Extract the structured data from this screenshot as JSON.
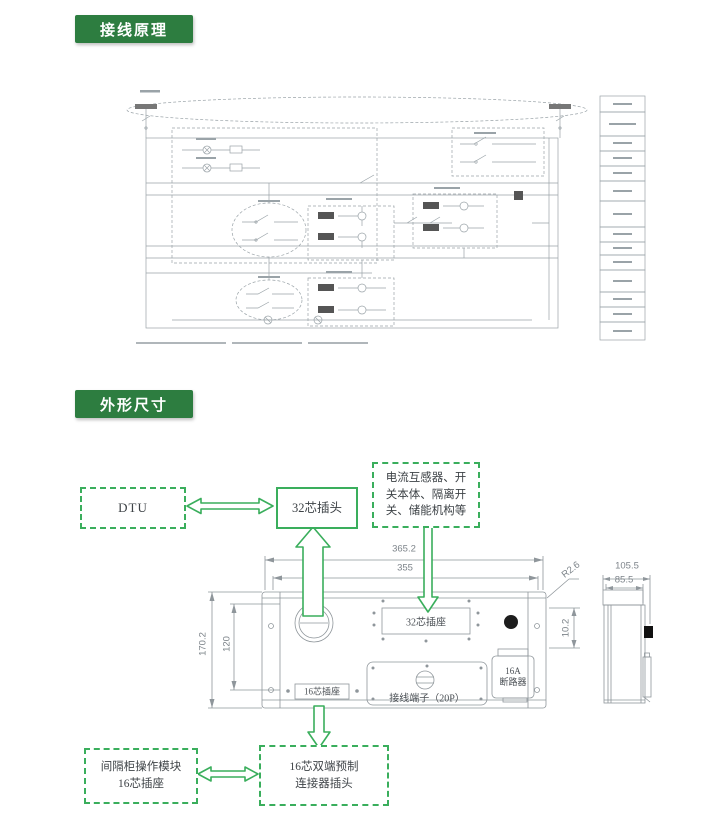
{
  "badges": {
    "wiring": "接线原理",
    "outline": "外形尺寸"
  },
  "colors": {
    "badge_bg": "#2d7d40",
    "accent_green": "#3aae5c",
    "drawing_gray": "#9aa3a8"
  },
  "callouts": {
    "dtu": "DTU",
    "plug32": "32芯插头",
    "devices_l1": "电流互感器、开",
    "devices_l2": "关本体、隔离开",
    "devices_l3": "关、储能机构等",
    "bay_l1": "间隔柜操作模块",
    "bay_l2": "16芯插座",
    "cable_l1": "16芯双端预制",
    "cable_l2": "连接器插头"
  },
  "panel": {
    "socket32": "32芯插座",
    "socket16": "16芯插座",
    "terminals": "接线端子（20P）",
    "breaker_l1": "16A",
    "breaker_l2": "断路器"
  },
  "dims": {
    "front_w_outer": "365.2",
    "front_w_inner": "355",
    "front_h_outer": "170.2",
    "front_h_inner": "120",
    "corner_r": "R2.6",
    "hole_offset": "10.2",
    "side_outer": "105.5",
    "side_inner": "85.5"
  }
}
